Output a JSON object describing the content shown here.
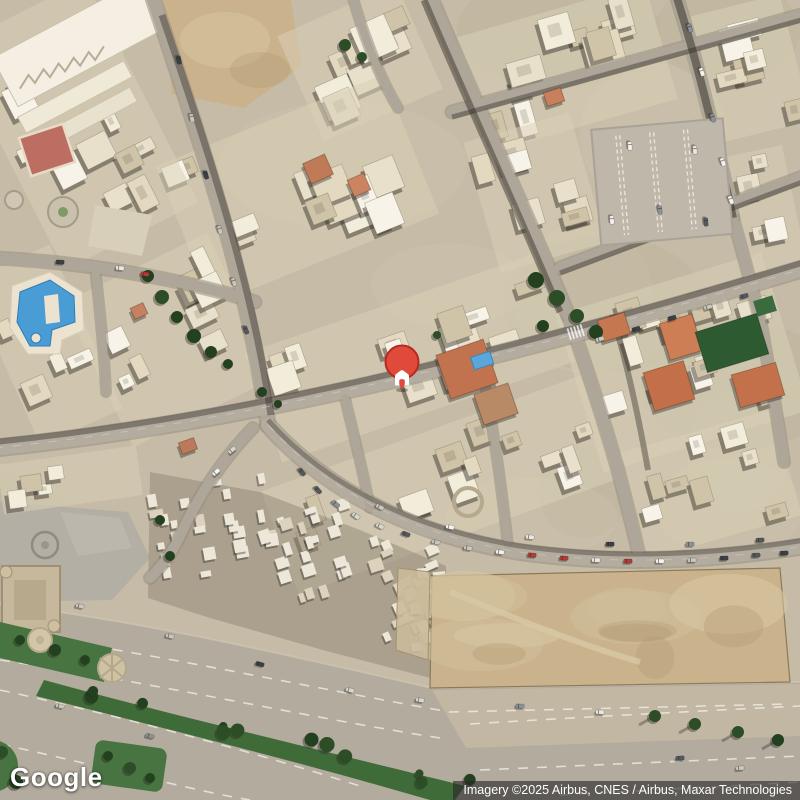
{
  "map_overlay": {
    "logo_text": "Google",
    "attribution_text": "Imagery ©2025 Airbus, CNES / Airbus, Maxar Technologies"
  },
  "marker": {
    "kind": "saved-place-pin",
    "icon": "home-icon",
    "pin_color": "#E04A3B",
    "pin_border_color": "#B5291E",
    "glyph_color": "#FFFFFF",
    "x": 402,
    "y": 362
  },
  "palette": {
    "ground": "#c6bba6",
    "building_light": "#f2ecdb",
    "building_mid": "#e3d9c1",
    "building_white": "#f7f3e8",
    "building_dark": "#cfc3a8",
    "old_town": "#ece7d9",
    "plaza": "#b3afa4",
    "road": "#ada699",
    "road_light": "#b3ac9f",
    "road_band": "#b2ab9e",
    "road_edge": "#958e80",
    "sidewalk": "#c1b7a2",
    "shadow": "#2e2922",
    "dirt": "#c9b28c",
    "dirt_light": "#d8c8a4",
    "dirt_dark": "#b29c74",
    "grass": "#477440",
    "grass_dark": "#3f6b38",
    "tree": "#23401f",
    "tree_light": "#2c4d26",
    "pool_water": "#4a9cd4",
    "pool_deep": "#2e7cb8",
    "terracotta": "#c3764f",
    "green_roof": "#2e5a32",
    "red_court": "#bd6e62",
    "lane_marking": "#efece4",
    "car_colors": [
      "#f4f2ec",
      "#d9d6cd",
      "#55595f",
      "#8d9197",
      "#b23c33",
      "#e9e7df",
      "#3c4046",
      "#c9c6bd"
    ]
  }
}
